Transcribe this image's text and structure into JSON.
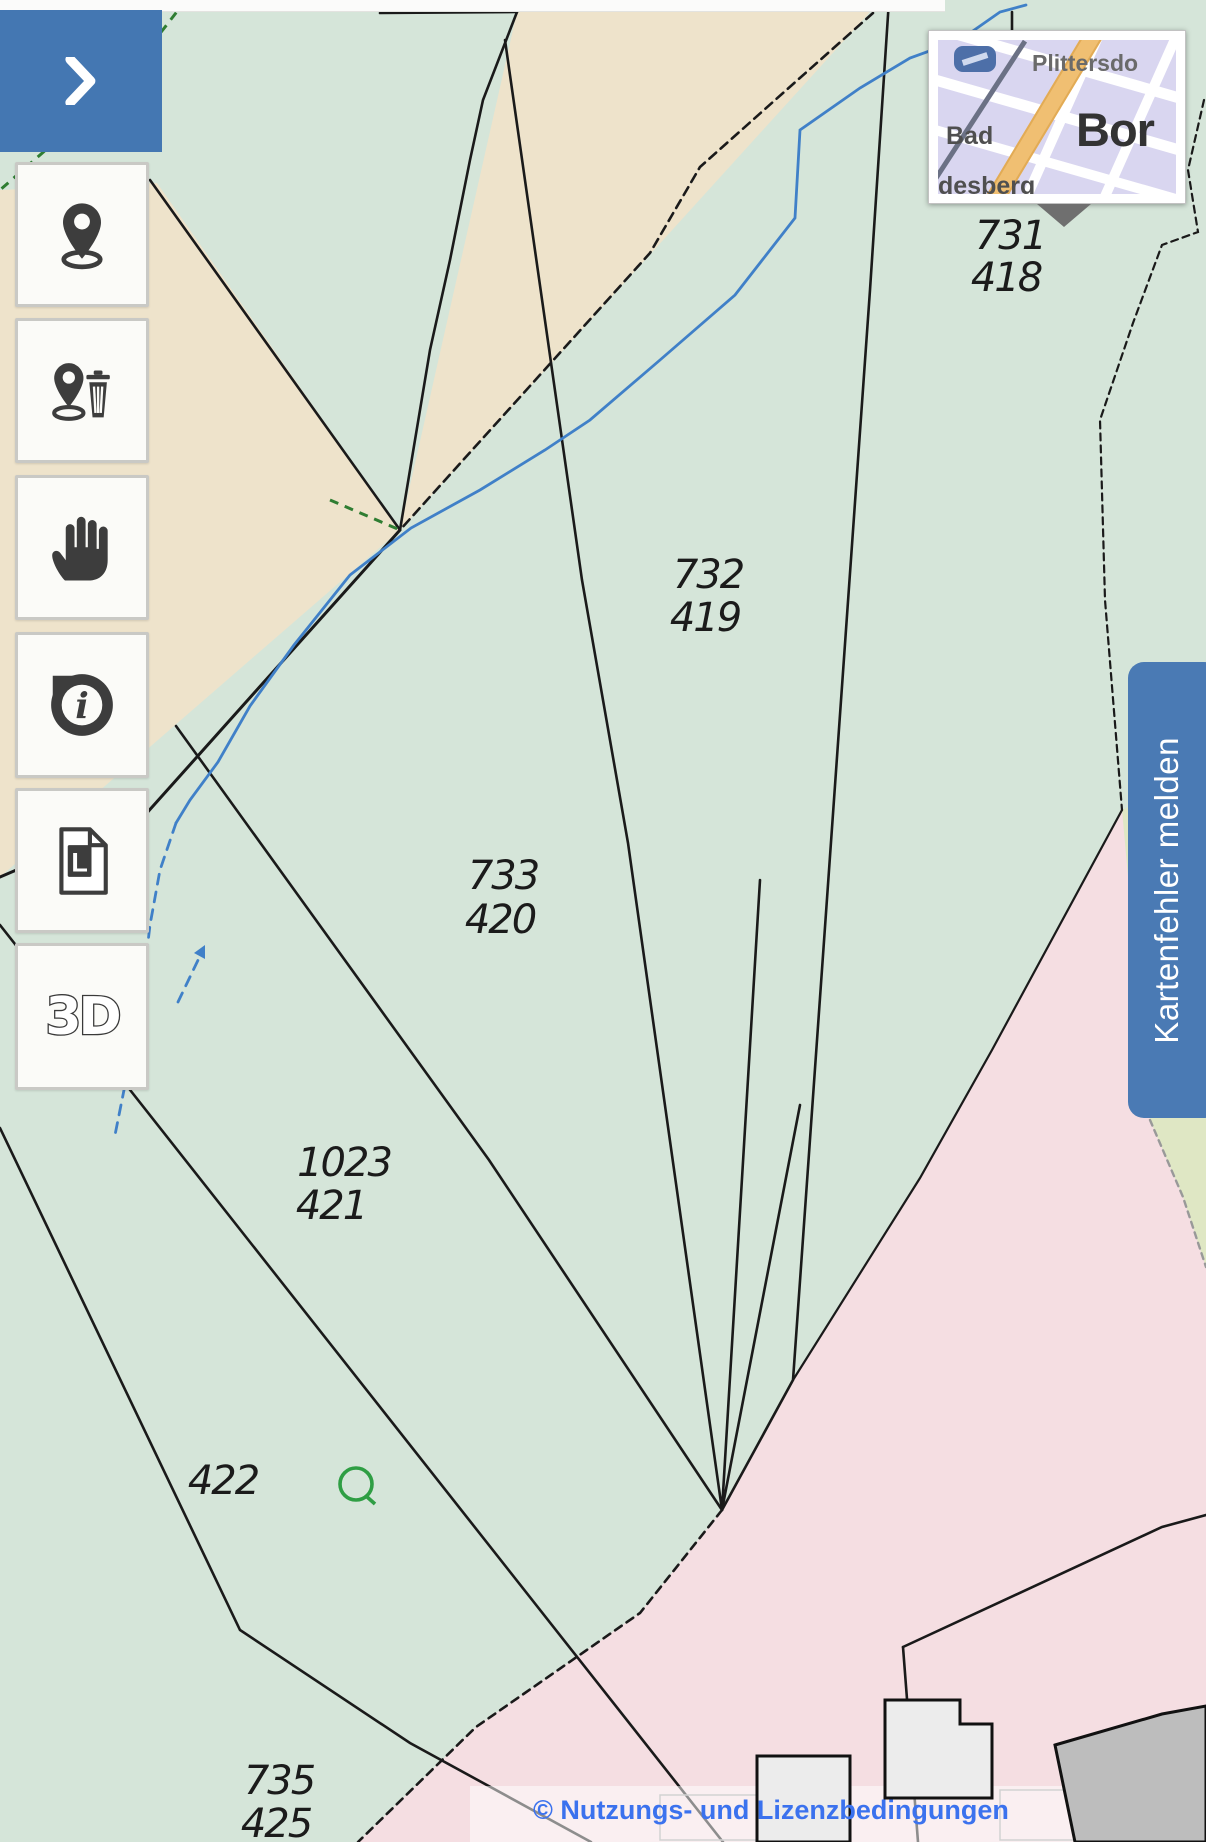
{
  "sidebar": {
    "buttons": [
      {
        "name": "expand-panel",
        "icon": "chevron-right-icon"
      },
      {
        "name": "set-marker",
        "icon": "location-marker-icon"
      },
      {
        "name": "remove-marker",
        "icon": "location-marker-delete-icon"
      },
      {
        "name": "pan",
        "icon": "pan-hand-icon"
      },
      {
        "name": "feature-info",
        "icon": "info-icon",
        "glyph": "i"
      },
      {
        "name": "legend",
        "icon": "legend-document-icon",
        "glyph": "L"
      },
      {
        "name": "view-3d",
        "icon": "3d-icon",
        "glyph": "3D"
      }
    ]
  },
  "overview_map": {
    "labels": {
      "top_right": "Plittersdo",
      "left": "Bad",
      "bottom_left": "desberg",
      "city": "Bor"
    }
  },
  "map": {
    "parcels": {
      "p731": {
        "num": "731",
        "den": "418"
      },
      "p732": {
        "num": "732",
        "den": "419"
      },
      "p733": {
        "num": "733",
        "den": "420"
      },
      "p1023": {
        "num": "1023",
        "den": "421"
      },
      "p422": {
        "num": "422"
      },
      "p735": {
        "num": "735",
        "den": "425"
      }
    },
    "symbols": [
      {
        "name": "spring-symbol-icon",
        "shape": "green-circle-with-tail"
      }
    ]
  },
  "report_button": {
    "label": "Kartenfehler melden"
  },
  "attribution": {
    "label": "© Nutzungs- und Lizenzbedingungen"
  },
  "colors": {
    "parcel_green": "#d5e5d9",
    "landuse_beige": "#eee3cb",
    "landuse_pink": "#f5dee2",
    "landuse_pale_yellow": "#dfe7c4",
    "boundary_black": "#1a1a1a",
    "stream_blue": "#4080c8",
    "municipal_green": "#2f7d32",
    "sidebar_blue": "#4477b2",
    "report_button_blue": "#4a7ab4",
    "attribution_blue": "#3b72ee"
  }
}
